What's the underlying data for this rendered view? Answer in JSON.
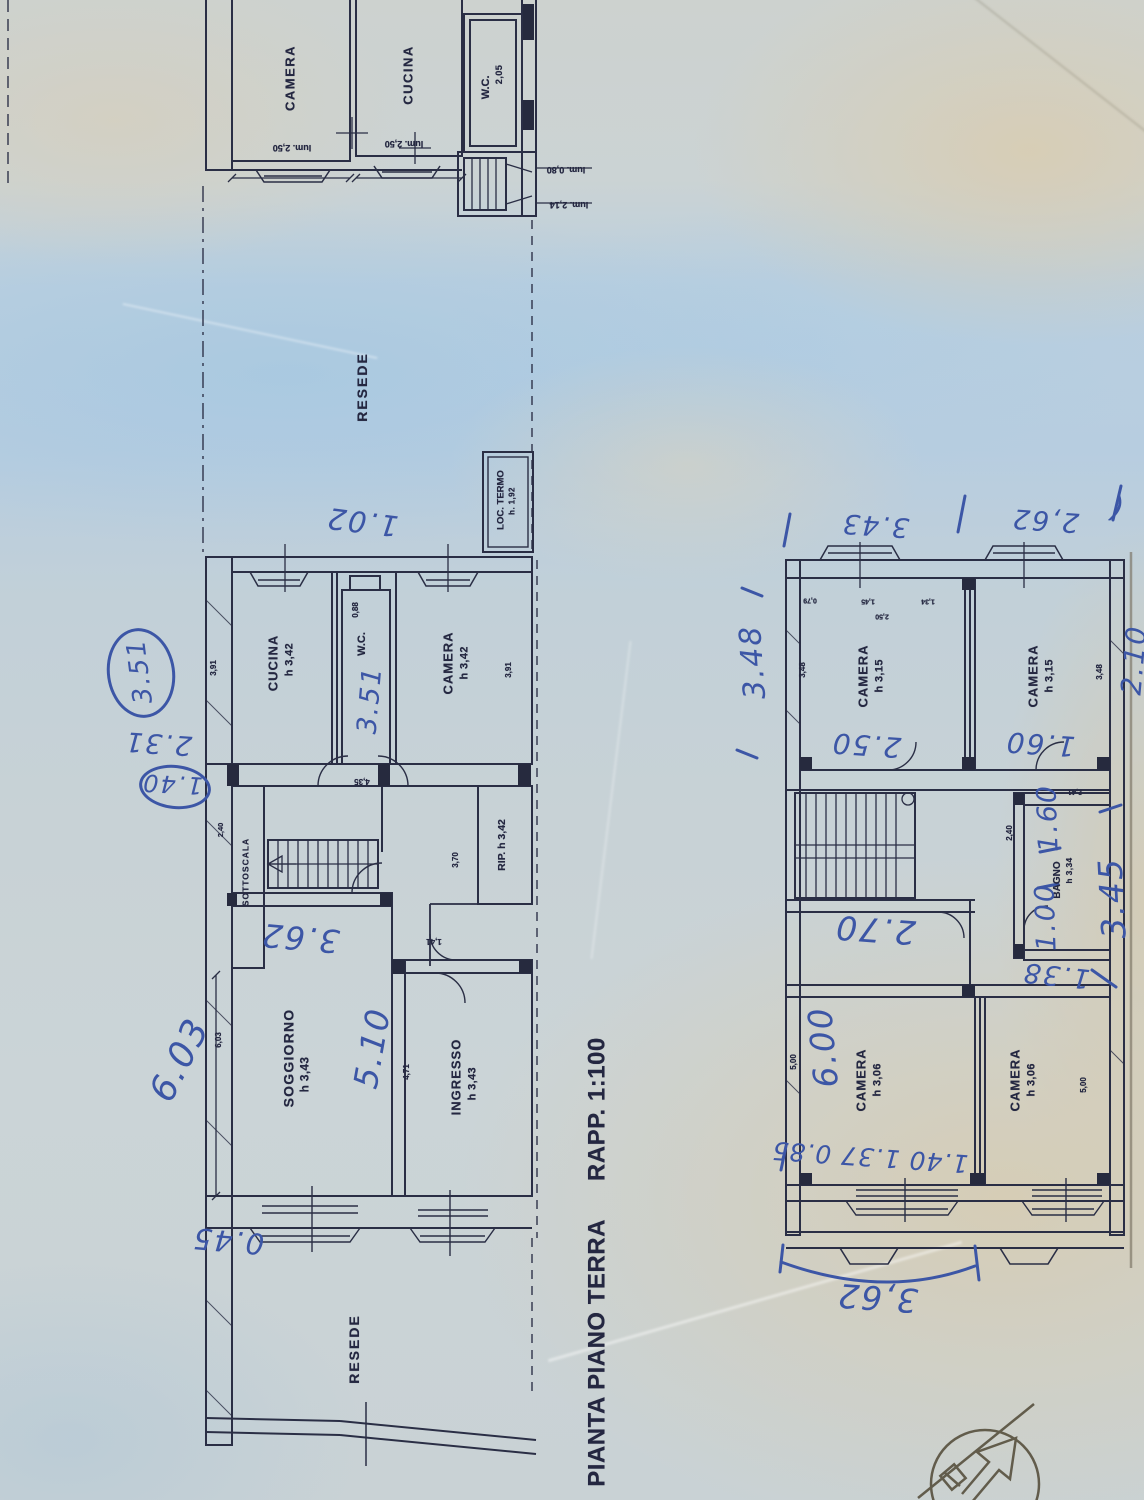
{
  "document": {
    "title": "PIANTA PIANO TERRA",
    "scale": "RAPP. 1:100"
  },
  "plans": {
    "top": {
      "camera": "CAMERA",
      "camera_lum": "lum. 2,50",
      "cucina": "CUCINA",
      "cucina_lum": "lum. 2,50",
      "wc": "W.C.",
      "wc_h": "2,05",
      "lum_short": "lum. 0,80",
      "lum_long": "lum. 2,14"
    },
    "ground": {
      "resede_top": "RESEDE",
      "loc_termo": "LOC. TERMO",
      "loc_termo_h": "h. 1,92",
      "cucina": "CUCINA",
      "cucina_h": "h 3,42",
      "wc": "W.C.",
      "camera": "CAMERA",
      "camera_h": "h 3,42",
      "sottoscala": "SOTTOSCALA",
      "rip": "RIP. h 3,42",
      "soggiorno": "SOGGIORNO",
      "soggiorno_h": "h 3,43",
      "ingresso": "INGRESSO",
      "ingresso_h": "h 3,43",
      "resede_bottom": "RESEDE",
      "dims": {
        "d088": "0,88",
        "d391a": "3,91",
        "d391b": "3,91",
        "d240": "2,40",
        "d435": "4,35",
        "d370": "3,70",
        "d141": "1,41",
        "d471": "4,71",
        "d603": "6,03"
      }
    },
    "first": {
      "camera_a": "CAMERA",
      "camera_a_h": "h 3,15",
      "camera_b": "CAMERA",
      "camera_b_h": "h 3,15",
      "bagno": "BAGNO",
      "bagno_h": "h 3,34",
      "camera_c": "CAMERA",
      "camera_c_h": "h 3,06",
      "camera_d": "CAMERA",
      "camera_d_h": "h 3,06",
      "dims": {
        "d079": "0,79",
        "d145": "1,45",
        "d134": "1,34",
        "d250": "2,50",
        "d348a": "3,48",
        "d348b": "3,48",
        "d241": "2,41",
        "d240": "2,40",
        "d500a": "5,00",
        "d500b": "5,00"
      }
    }
  },
  "annotations": {
    "a351": "3.51",
    "a231": "2.31",
    "a140": "1.40",
    "a102": "1.02",
    "a362": "3.62",
    "a510": "5.10",
    "a603": "6.03",
    "a045": "0.45",
    "awc351": "3.51",
    "a262": "2,62",
    "a343": "3.43",
    "paren": "(",
    "a348": "3.48",
    "a250": "2.50",
    "a160a": "1.60",
    "a210": "2.10",
    "a270": "2.70",
    "a160b": "1.60",
    "a100": "1.00",
    "a138": "1.38",
    "a345": "3.45",
    "a600": "6.00",
    "arow": "1.40  1.37  0.85",
    "a362b": "3,62"
  },
  "colors": {
    "ink": "#2a2e45",
    "pen": "#3c56a6",
    "paper_blue": "#b6cddf",
    "paper_beige": "#d6cdb8"
  }
}
